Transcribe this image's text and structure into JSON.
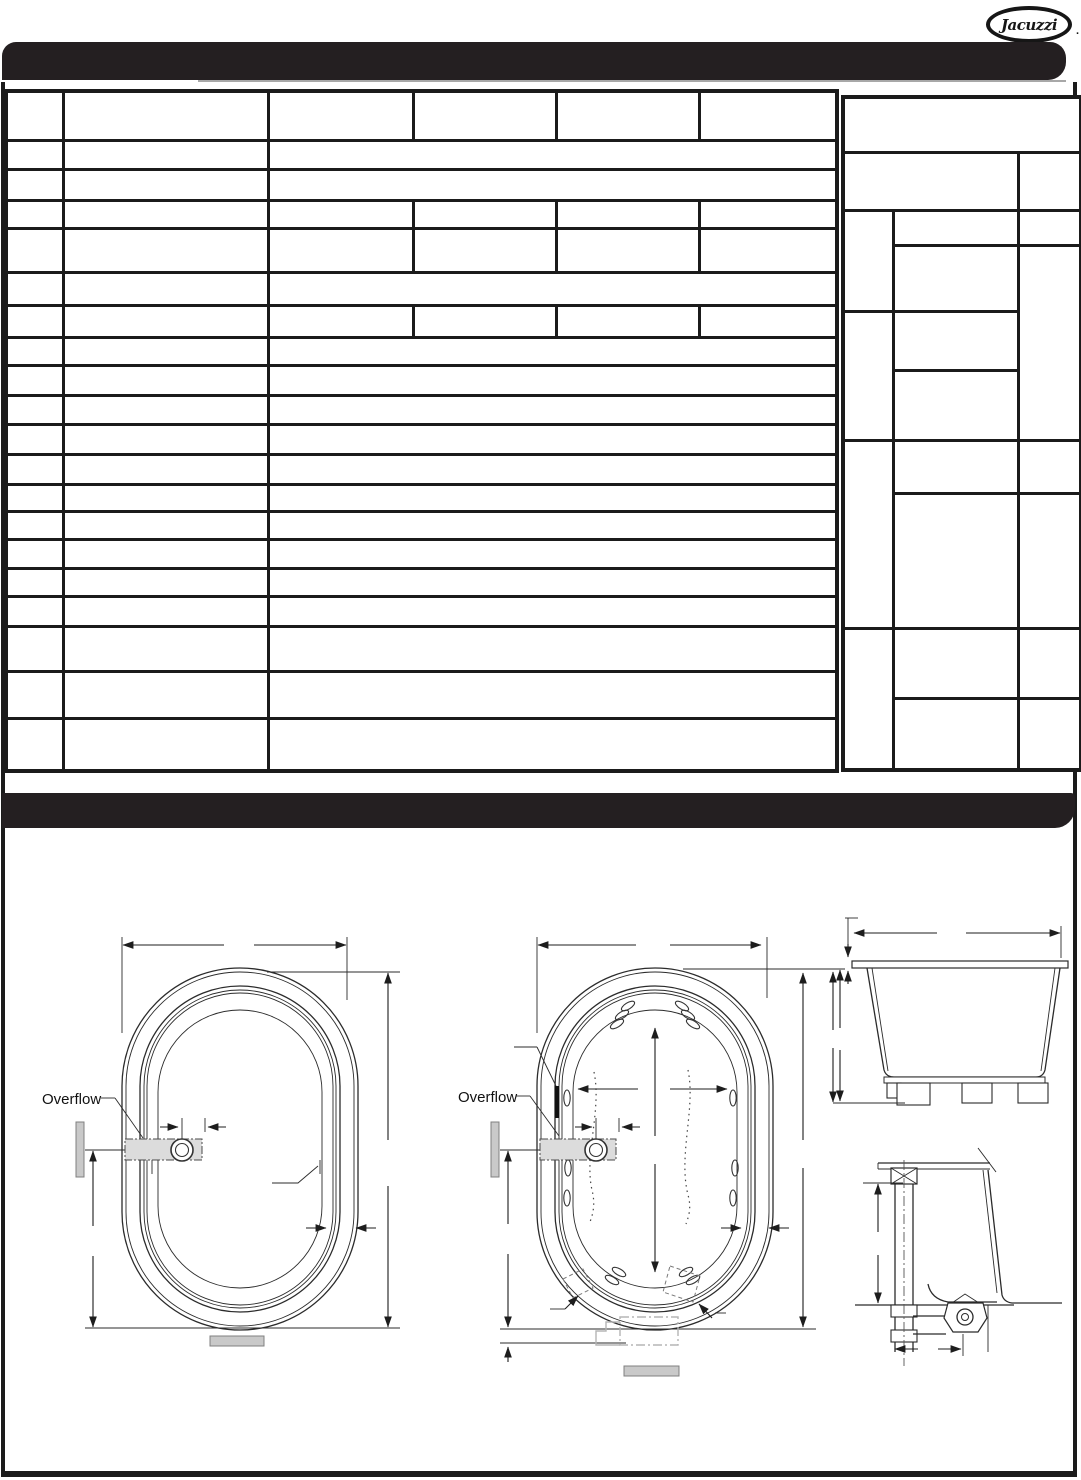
{
  "logo": {
    "text": "Jacuzzi",
    "mark": "."
  },
  "top_bar": {
    "text": ""
  },
  "section_bar": {
    "text": ""
  },
  "spec_table": {
    "cells_text": ""
  },
  "drawings": {
    "plain_tub": {
      "overflow_label": "Overflow"
    },
    "jetted_tub": {
      "overflow_label": "Overflow"
    }
  },
  "colors": {
    "bar_black": "#241f21",
    "table_line": "#1b1b1b",
    "gray_fill": "#c9c9c9",
    "shadow_gray": "#a8a8a8"
  }
}
